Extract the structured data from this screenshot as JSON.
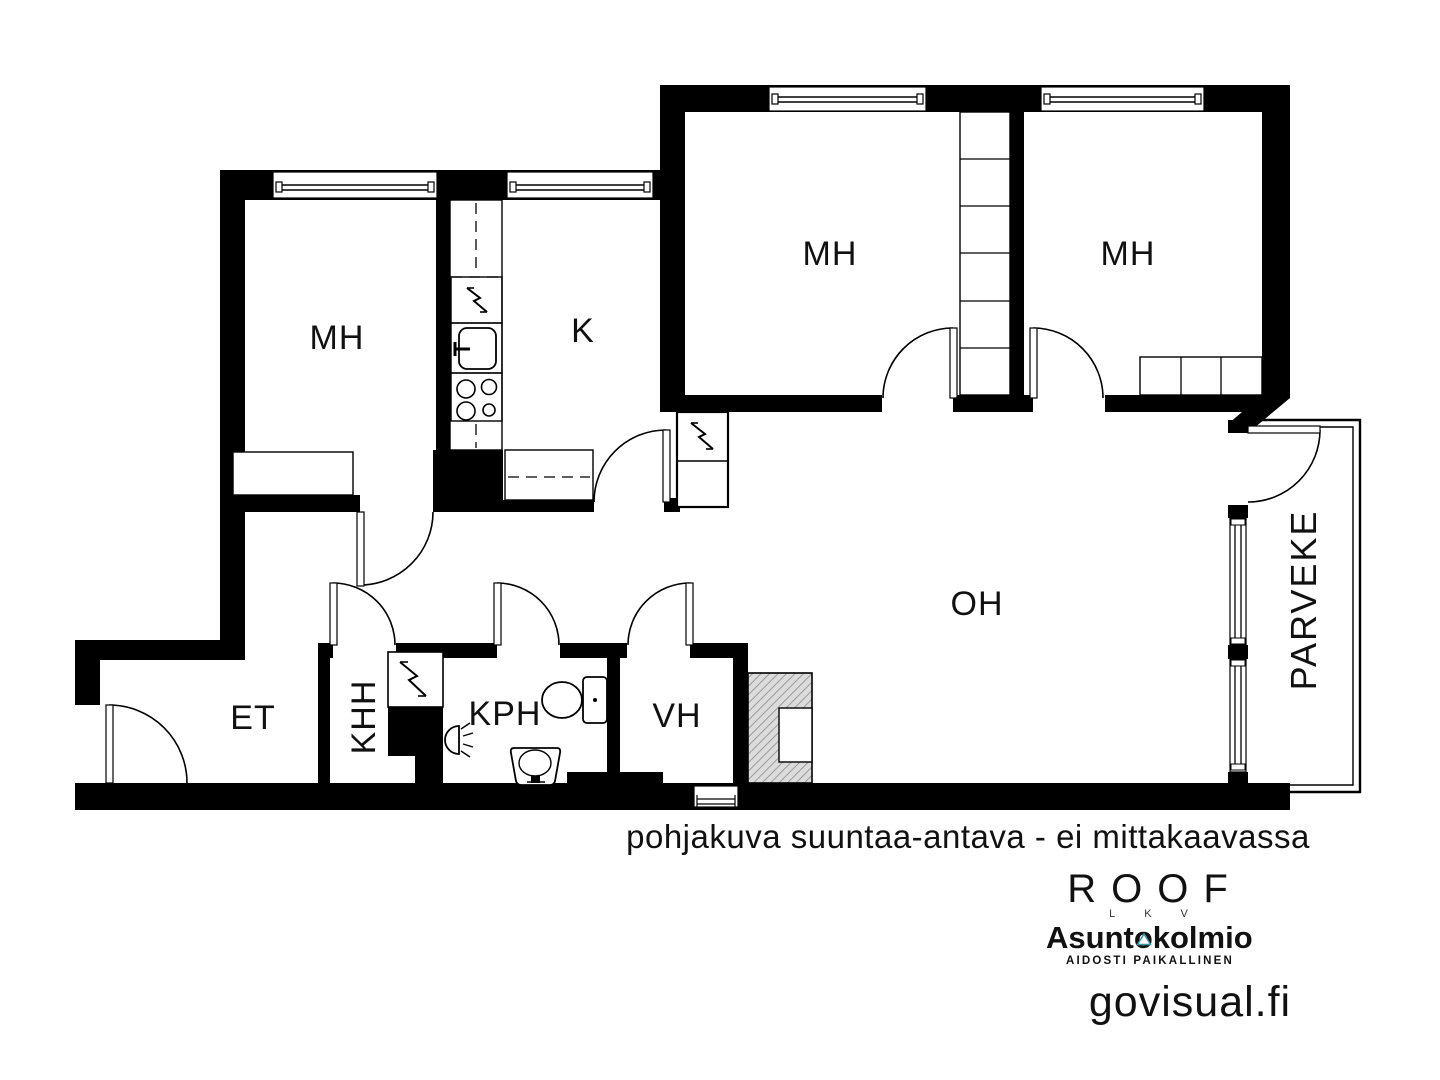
{
  "floorplan": {
    "rooms": [
      {
        "id": "mh-top-left",
        "label": "MH"
      },
      {
        "id": "kitchen",
        "label": "K"
      },
      {
        "id": "mh-middle",
        "label": "MH"
      },
      {
        "id": "mh-right",
        "label": "MH"
      },
      {
        "id": "living-room",
        "label": "OH"
      },
      {
        "id": "entrance",
        "label": "ET"
      },
      {
        "id": "utility-room",
        "label": "KHH"
      },
      {
        "id": "bathroom",
        "label": "KPH"
      },
      {
        "id": "closet-room",
        "label": "VH"
      },
      {
        "id": "balcony",
        "label": "PARVEKE"
      }
    ],
    "disclaimer": "pohjakuva suuntaa-antava - ei mittakaavassa"
  },
  "branding": {
    "roof_logo": "ROOF",
    "roof_sub": "LKV",
    "brand_name": "Asuntokolmio",
    "brand_tagline": "AIDOSTI PAIKALLINEN",
    "credit": "govisual.fi"
  },
  "colors": {
    "walls": "#000000",
    "disclaimer_gray": "#a9a9a9",
    "credit_gray": "#9c9c9c",
    "brand_teal": "#359aa1"
  }
}
